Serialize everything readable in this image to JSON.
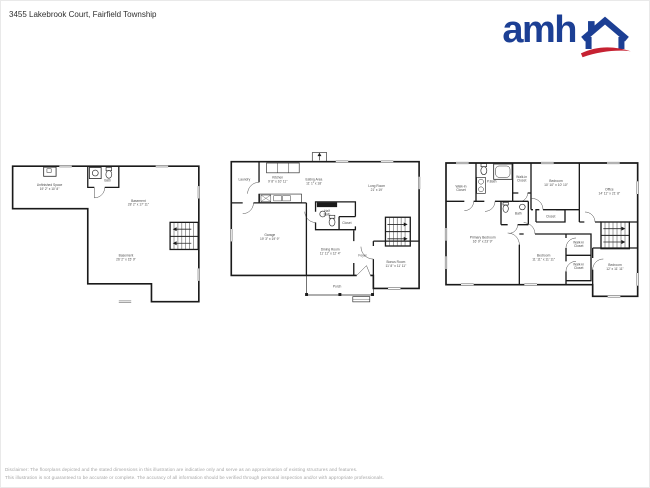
{
  "theme": {
    "brand_blue": "#1c3f94",
    "brand_red": "#c62232",
    "wall_color": "#1a1a1a",
    "label_color": "#4a4a4a",
    "footer_color": "#a6a6a6"
  },
  "header": {
    "address": "3455 Lakebrook Court, Fairfield Township"
  },
  "logo": {
    "text": "amh",
    "house_icon": "house-with-chimney-and-red-swoosh"
  },
  "floors": {
    "basement": {
      "rooms": [
        {
          "line1": "Unfinished Space",
          "line2": "19' 2\" x 10' 8\""
        },
        {
          "line1": "Bath"
        },
        {
          "line1": "Basement",
          "line2": "28' 2\" x 17' 11\""
        },
        {
          "line1": "Basement",
          "line2": "26' 2\" x 15' 9\""
        }
      ]
    },
    "main_floor": {
      "rooms": [
        {
          "line1": "Laundry"
        },
        {
          "line1": "Kitchen",
          "line2": "9' 8\" x 10' 11\""
        },
        {
          "line1": "Eating Area",
          "line2": "11' 1\" x 18'"
        },
        {
          "line1": "Long Room",
          "line2": "21' x 19'"
        },
        {
          "line1": "Half",
          "line2": "Bath"
        },
        {
          "line1": "Closet"
        },
        {
          "line1": "Garage",
          "line2": "19' 3\" x 19' 9\""
        },
        {
          "line1": "Dining Room",
          "line2": "11' 11\" x 12' 4\""
        },
        {
          "line1": "Foyer"
        },
        {
          "line1": "Bonus Room",
          "line2": "11' 8\" x 11' 11\""
        },
        {
          "line1": "Porch"
        }
      ]
    },
    "second_floor": {
      "rooms": [
        {
          "line1": "Walk-in",
          "line2": "Closet"
        },
        {
          "line1": "P.Bath"
        },
        {
          "line1": "Walk-in",
          "line2": "Closet"
        },
        {
          "line1": "Bedroom",
          "line2": "10' 10\" x 10' 10\""
        },
        {
          "line1": "Office",
          "line2": "14' 11\" x 21' 8\""
        },
        {
          "line1": "Bath"
        },
        {
          "line1": "Closet"
        },
        {
          "line1": "Primary Bedroom",
          "line2": "16' 9\" x 23' 9\""
        },
        {
          "line1": "Bedroom",
          "line2": "11' 11\" x 11' 11\""
        },
        {
          "line1": "Walk-in",
          "line2": "Closet"
        },
        {
          "line1": "Walk-in",
          "line2": "Closet"
        },
        {
          "line1": "Bedroom",
          "line2": "12' x 11' 11\""
        }
      ]
    }
  },
  "footer": {
    "line1": "Disclaimer: The floorplans depicted and the stated dimensions in this illustration are indicative only and serve as an approximation of existing structures and features.",
    "line2": "This illustration is not guaranteed to be accurate or complete. The accuracy of all information should be verified through personal inspection and/or with appropriate professionals."
  }
}
